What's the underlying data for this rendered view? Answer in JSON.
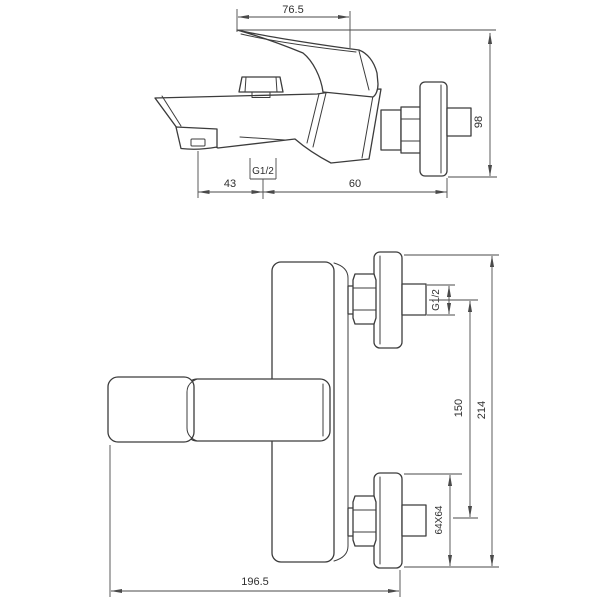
{
  "drawing": {
    "colors": {
      "background": "#ffffff",
      "part_line": "#3c3c3c",
      "dimension_line": "#4a4a4a",
      "text": "#2f2f2f"
    },
    "top_view": {
      "dim_handle_length": "76.5",
      "dim_height": "98",
      "dim_spout_offset": "43",
      "dim_thread": "G1/2",
      "dim_wall_offset": "60"
    },
    "front_view": {
      "dim_thread": "G1/2",
      "dim_center_distance": "150",
      "dim_total_height": "214",
      "dim_escutcheon": "64X64",
      "dim_total_width": "196.5"
    }
  }
}
